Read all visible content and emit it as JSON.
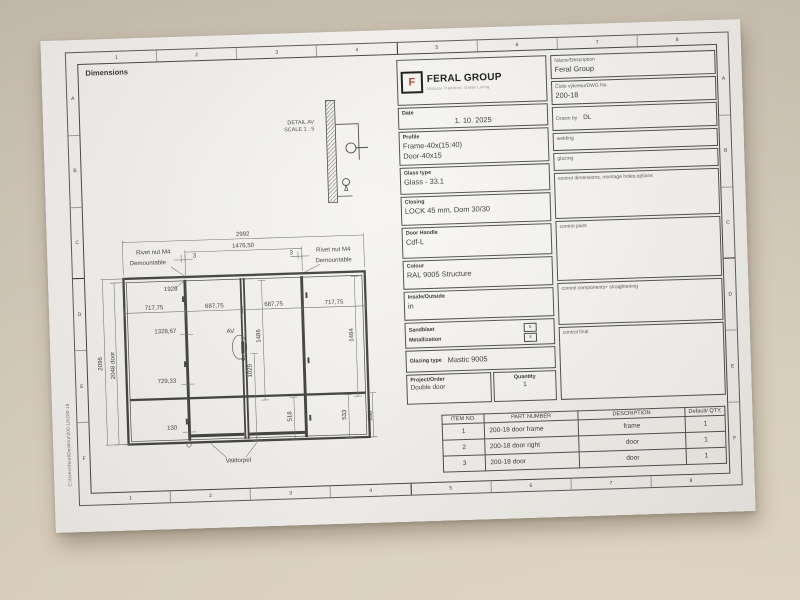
{
  "sheet": {
    "dimensions_label": "Dimensions",
    "margin_note": "C:\\Users\\feral\\Desktop\\200-18\\200-18",
    "zone_numbers": [
      "1",
      "2",
      "3",
      "4",
      "5",
      "6",
      "7",
      "8"
    ],
    "zone_letters": [
      "A",
      "B",
      "C",
      "D",
      "E",
      "F"
    ]
  },
  "logo": {
    "mark_letter": "F",
    "name": "FERAL GROUP",
    "tagline": "Natural Tradition, Great Living"
  },
  "title_block": {
    "name_label": "Názov/Description",
    "name_value": "Feral Group",
    "dwg_label": "Číslo výkresu/DWG No.",
    "dwg_value": "200-18",
    "date_label": "Date",
    "date_value": "1. 10. 2025",
    "drawn_label": "Drawn by",
    "drawn_value": "DL",
    "profile_label": "Profile",
    "profile_line1": "Frame-40x(15:40)",
    "profile_line2": "Door-40x15",
    "glass_label": "Glass type",
    "glass_value": "Glass - 33.1",
    "closing_label": "Closing",
    "closing_value": "LOCK 45 mm, Dom 30/30",
    "handle_label": "Door Handle",
    "handle_value": "Cdf-L",
    "colour_label": "Colour",
    "colour_value": "RAL 9005 Structure",
    "inside_label": "Inside/Outside",
    "inside_value": "in",
    "sandblast_label": "Sandblast",
    "sandblast_mark": "x",
    "metallization_label": "Metallization",
    "metallization_mark": "x",
    "glazing_label": "Glazing type",
    "glazing_value": "Mastic 9005",
    "project_label": "Project/Order",
    "project_value": "Double door",
    "quantity_label": "Quantity",
    "quantity_value": "1",
    "checklist": [
      "welding",
      "glazing",
      "control dimensions, montage holes,options",
      "control paint",
      "control components+ straightening",
      "control final"
    ]
  },
  "detail": {
    "title": "DETAIL AV",
    "scale": "SCALE 1 : 5"
  },
  "parts_table": {
    "headers": [
      "ITEM NO.",
      "PART NUMBER",
      "DESCRIPTION",
      "Default/ QTY."
    ],
    "rows": [
      [
        "1",
        "200-18 door frame",
        "frame",
        "1"
      ],
      [
        "2",
        "200-18 door right",
        "door",
        "1"
      ],
      [
        "3",
        "200-18 door",
        "door",
        "1"
      ]
    ]
  },
  "drawing": {
    "label": "Double door elevation",
    "annotations": [
      {
        "t": "2992",
        "x": 162,
        "y": 11
      },
      {
        "t": "1476,50",
        "x": 162,
        "y": 23
      },
      {
        "t": "3",
        "x": 111,
        "y": 32
      },
      {
        "t": "3",
        "x": 212,
        "y": 32
      },
      {
        "t": "Rivet nut M4",
        "x": 68,
        "y": 27
      },
      {
        "t": "Demountable",
        "x": 62,
        "y": 38
      },
      {
        "t": "Rivet nut M4",
        "x": 256,
        "y": 30
      },
      {
        "t": "Demountable",
        "x": 256,
        "y": 41
      },
      {
        "t": "1928",
        "x": 85,
        "y": 66
      },
      {
        "t": "717,75",
        "x": 67,
        "y": 85
      },
      {
        "t": "687,75",
        "x": 130,
        "y": 85
      },
      {
        "t": "687,75",
        "x": 192,
        "y": 85
      },
      {
        "t": "717,75",
        "x": 255,
        "y": 85
      },
      {
        "t": "2096",
        "x": 11,
        "y": 140,
        "r": -90
      },
      {
        "t": "2048 door",
        "x": 24,
        "y": 142,
        "r": -90
      },
      {
        "t": "1328,67",
        "x": 78,
        "y": 110
      },
      {
        "t": "AV",
        "x": 146,
        "y": 112
      },
      {
        "t": "1486",
        "x": 177,
        "y": 116,
        "r": -90
      },
      {
        "t": "1029",
        "x": 167,
        "y": 152,
        "r": -90
      },
      {
        "t": "729,33",
        "x": 78,
        "y": 162
      },
      {
        "t": "1484",
        "x": 274,
        "y": 118,
        "r": -90
      },
      {
        "t": "518",
        "x": 207,
        "y": 201,
        "r": -90
      },
      {
        "t": "533",
        "x": 264,
        "y": 201,
        "r": -90
      },
      {
        "t": "550",
        "x": 291,
        "y": 203,
        "r": -90
      },
      {
        "t": "130",
        "x": 82,
        "y": 211
      },
      {
        "t": "Valdorpel",
        "x": 150,
        "y": 247
      }
    ]
  },
  "colors": {
    "logo_red": "#b23a28",
    "ink": "#3a3a3a",
    "paper": "#f4f3f0",
    "desk": "#d6ccbb"
  }
}
